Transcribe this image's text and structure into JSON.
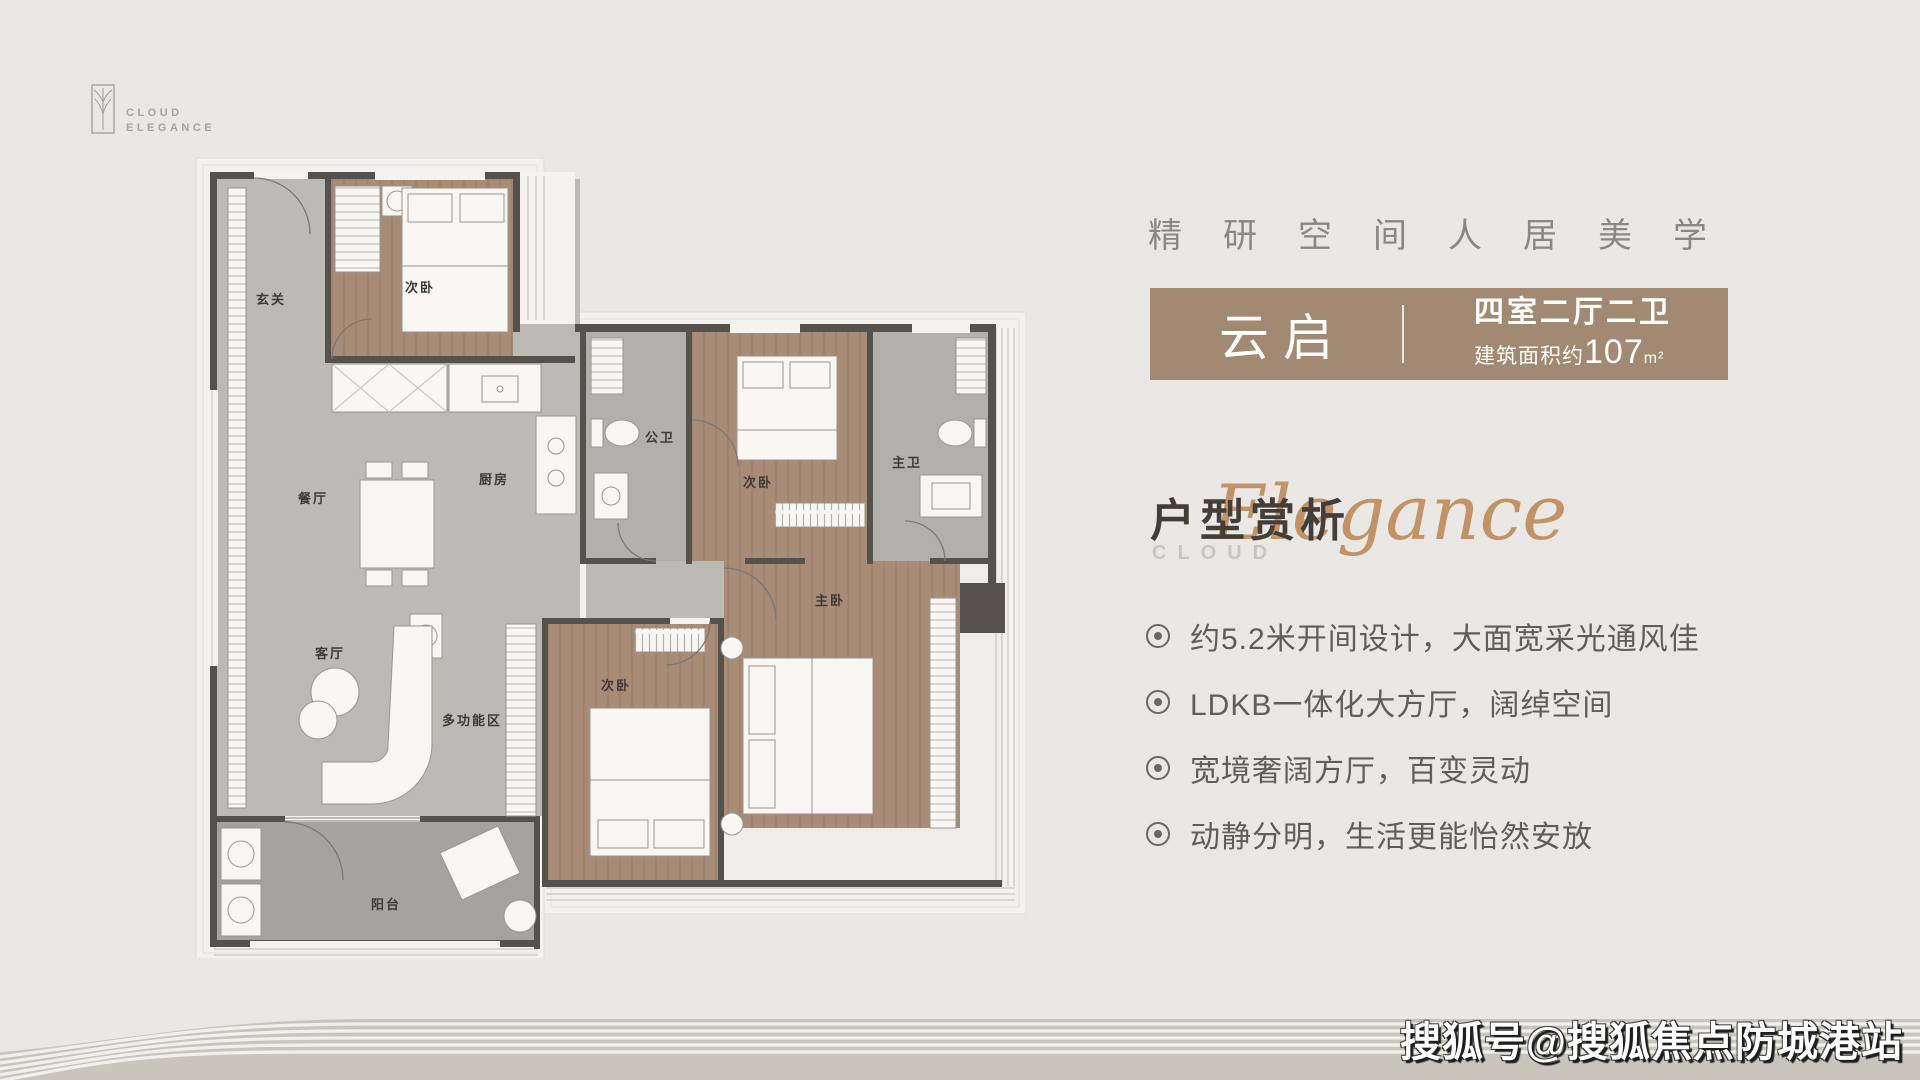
{
  "logo": {
    "brand_line1": "CLOUD",
    "brand_line2": "ELEGANCE"
  },
  "headline": {
    "text": "精研空间人居美学"
  },
  "unit_card": {
    "name": "云启",
    "layout": "四室二厅二卫",
    "area_label": "建筑面积约",
    "area_value": "107",
    "area_unit": "m²",
    "bg_color": "#a28a72"
  },
  "section": {
    "title": "户型赏析",
    "eyebrow": "CLOUD",
    "script_word": "Elegance"
  },
  "features": [
    {
      "text": "约5.2米开间设计，大面宽采光通风佳"
    },
    {
      "text": "LDKB一体化大方厅，阔绰空间"
    },
    {
      "text": "宽境奢阔方厅，百变灵动"
    },
    {
      "text": "动静分明，生活更能怡然安放"
    }
  ],
  "floorplan": {
    "rooms": [
      {
        "id": "entry",
        "label": "玄关"
      },
      {
        "id": "bedroom-top",
        "label": "次卧"
      },
      {
        "id": "dining",
        "label": "餐厅"
      },
      {
        "id": "kitchen",
        "label": "厨房"
      },
      {
        "id": "public-bath",
        "label": "公卫"
      },
      {
        "id": "bedroom-mid",
        "label": "次卧"
      },
      {
        "id": "master-bath",
        "label": "主卫"
      },
      {
        "id": "master-bedroom",
        "label": "主卧"
      },
      {
        "id": "living",
        "label": "客厅"
      },
      {
        "id": "multi-zone",
        "label": "多功能区"
      },
      {
        "id": "bedroom-bottom",
        "label": "次卧"
      },
      {
        "id": "balcony",
        "label": "阳台"
      }
    ]
  },
  "watermark": {
    "text": "搜狐号@搜狐焦点防城港站"
  },
  "colors": {
    "background": "#e9e8e5",
    "accent_brown": "#a28a72",
    "script_tan": "#c08a58",
    "wall": "#55524e",
    "wood_floor": "#a98c76",
    "gray_floor": "#bcbab5"
  }
}
